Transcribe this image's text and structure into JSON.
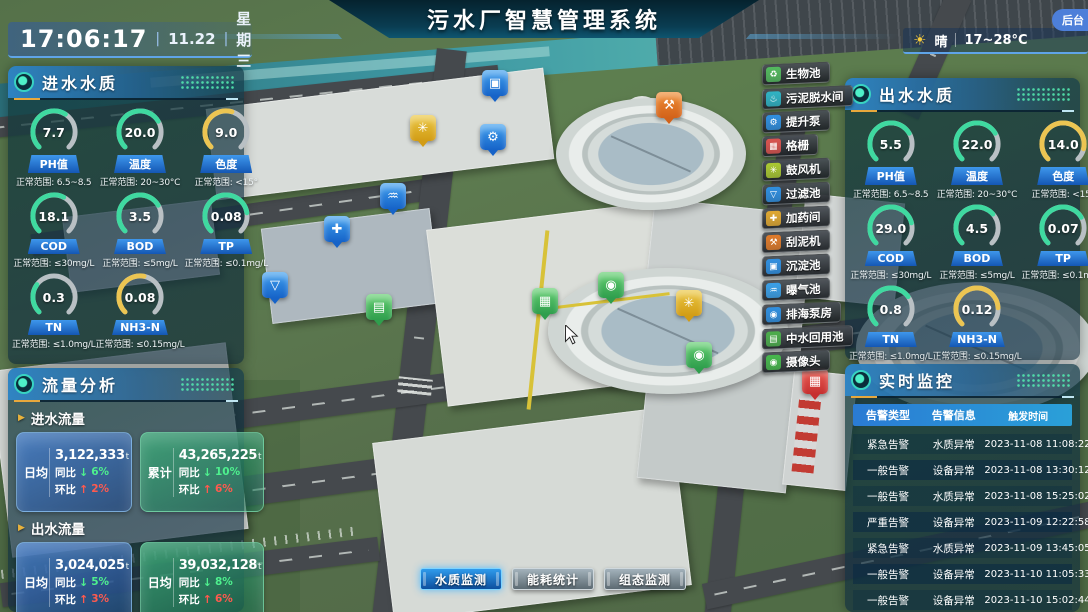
{
  "header": {
    "title": "污水厂智慧管理系统",
    "time": "17:06:17",
    "date": "11.22",
    "weekday": "星期三",
    "weather": {
      "icon": "sun-icon",
      "condition": "晴",
      "temp_range": "17~28°C"
    },
    "backend_label": "后台"
  },
  "colors": {
    "green": "#3fd9a0",
    "yellow": "#ecc552",
    "blue_accent": "#2f8de8",
    "track": "#b9c0c4"
  },
  "inlet_quality": {
    "title": "进水水质",
    "gauges": [
      {
        "label": "PH值",
        "value": "7.7",
        "range": "正常范围: 6.5~8.5",
        "color": "green",
        "percent": 62
      },
      {
        "label": "温度",
        "value": "20.0",
        "range": "正常范围: 20~30°C",
        "color": "green",
        "percent": 72
      },
      {
        "label": "色度",
        "value": "9.0",
        "range": "正常范围: <15°",
        "color": "yellow",
        "percent": 56
      },
      {
        "label": "COD",
        "value": "18.1",
        "range": "正常范围: ≤30mg/L",
        "color": "green",
        "percent": 60
      },
      {
        "label": "BOD",
        "value": "3.5",
        "range": "正常范围: ≤5mg/L",
        "color": "green",
        "percent": 72
      },
      {
        "label": "TP",
        "value": "0.08",
        "range": "正常范围: ≤0.1mg/L",
        "color": "green",
        "percent": 80
      },
      {
        "label": "TN",
        "value": "0.3",
        "range": "正常范围: ≤1.0mg/L",
        "color": "green",
        "percent": 30
      },
      {
        "label": "NH3-N",
        "value": "0.08",
        "range": "正常范围: ≤0.15mg/L",
        "color": "yellow",
        "percent": 54
      }
    ]
  },
  "outlet_quality": {
    "title": "出水水质",
    "gauges": [
      {
        "label": "PH值",
        "value": "5.5",
        "range": "正常范围: 6.5~8.5",
        "color": "green",
        "percent": 72
      },
      {
        "label": "温度",
        "value": "22.0",
        "range": "正常范围: 20~30°C",
        "color": "green",
        "percent": 72
      },
      {
        "label": "色度",
        "value": "14.0",
        "range": "正常范围: <15°",
        "color": "yellow",
        "percent": 88
      },
      {
        "label": "COD",
        "value": "29.0",
        "range": "正常范围: ≤30mg/L",
        "color": "green",
        "percent": 78
      },
      {
        "label": "BOD",
        "value": "4.5",
        "range": "正常范围: ≤5mg/L",
        "color": "green",
        "percent": 68
      },
      {
        "label": "TP",
        "value": "0.07",
        "range": "正常范围: ≤0.1mg/L",
        "color": "green",
        "percent": 72
      },
      {
        "label": "TN",
        "value": "0.8",
        "range": "正常范围: ≤1.0mg/L",
        "color": "green",
        "percent": 70
      },
      {
        "label": "NH3-N",
        "value": "0.12",
        "range": "正常范围: ≤0.15mg/L",
        "color": "yellow",
        "percent": 82
      }
    ]
  },
  "flow_analysis": {
    "title": "流量分析",
    "groups": [
      {
        "subtitle": "进水流量",
        "cards": [
          {
            "label": "日均",
            "value": "3,122,333",
            "unit": "t",
            "style": "blue",
            "yoy": {
              "label": "同比",
              "value": "6%",
              "trend": "down"
            },
            "mom": {
              "label": "环比",
              "value": "2%",
              "trend": "up"
            }
          },
          {
            "label": "累计",
            "value": "43,265,225",
            "unit": "t",
            "style": "green",
            "yoy": {
              "label": "同比",
              "value": "10%",
              "trend": "down"
            },
            "mom": {
              "label": "环比",
              "value": "6%",
              "trend": "up"
            }
          }
        ]
      },
      {
        "subtitle": "出水流量",
        "cards": [
          {
            "label": "日均",
            "value": "3,024,025",
            "unit": "t",
            "style": "blue",
            "yoy": {
              "label": "同比",
              "value": "5%",
              "trend": "down"
            },
            "mom": {
              "label": "环比",
              "value": "3%",
              "trend": "up"
            }
          },
          {
            "label": "日均",
            "value": "39,032,128",
            "unit": "t",
            "style": "green",
            "yoy": {
              "label": "同比",
              "value": "8%",
              "trend": "down"
            },
            "mom": {
              "label": "环比",
              "value": "6%",
              "trend": "up"
            }
          }
        ]
      }
    ]
  },
  "monitoring": {
    "title": "实时监控",
    "columns": [
      "告警类型",
      "告警信息",
      "触发时间"
    ],
    "rows": [
      [
        "紧急告警",
        "水质异常",
        "2023-11-08 11:08:22"
      ],
      [
        "一般告警",
        "设备异常",
        "2023-11-08 13:30:12"
      ],
      [
        "一般告警",
        "水质异常",
        "2023-11-08 15:25:02"
      ],
      [
        "严重告警",
        "设备异常",
        "2023-11-09 12:22:58"
      ],
      [
        "紧急告警",
        "水质异常",
        "2023-11-09 13:45:05"
      ],
      [
        "一般告警",
        "设备异常",
        "2023-11-10 11:05:33"
      ],
      [
        "一般告警",
        "设备异常",
        "2023-11-10 15:02:44"
      ]
    ]
  },
  "legend": {
    "items": [
      {
        "label": "生物池",
        "icon": "bio-pool-icon",
        "glyph": "bio",
        "color": "#53b95e"
      },
      {
        "label": "污泥脱水间",
        "icon": "sludge-dewatering-icon",
        "glyph": "dewater",
        "color": "#2fb3c4"
      },
      {
        "label": "提升泵",
        "icon": "lift-pump-icon",
        "glyph": "pump",
        "color": "#2f8fe0"
      },
      {
        "label": "格栅",
        "icon": "grille-icon",
        "glyph": "grille",
        "color": "#d9534f"
      },
      {
        "label": "鼓风机",
        "icon": "blower-icon",
        "glyph": "fan",
        "color": "#aac832"
      },
      {
        "label": "过滤池",
        "icon": "filter-pool-icon",
        "glyph": "funnel",
        "color": "#2f8fe0"
      },
      {
        "label": "加药间",
        "icon": "dosing-room-icon",
        "glyph": "dosing",
        "color": "#e0a831"
      },
      {
        "label": "刮泥机",
        "icon": "mud-scraper-icon",
        "glyph": "scraper",
        "color": "#e07b2a"
      },
      {
        "label": "沉淀池",
        "icon": "sedimentation-icon",
        "glyph": "tank",
        "color": "#2f8fe0"
      },
      {
        "label": "曝气池",
        "icon": "aeration-pool-icon",
        "glyph": "aeration",
        "color": "#3aa0e8"
      },
      {
        "label": "排海泵房",
        "icon": "sea-pump-house-icon",
        "glyph": "pumphouse",
        "color": "#2f8fe0"
      },
      {
        "label": "中水回用池",
        "icon": "water-reuse-pool-icon",
        "glyph": "reuse",
        "color": "#4cae4c"
      },
      {
        "label": "摄像头",
        "icon": "camera-icon",
        "glyph": "camera",
        "color": "#46b84c"
      }
    ]
  },
  "map": {
    "markers": [
      {
        "name": "sedimentation-marker",
        "glyph": "tank",
        "color": "blue",
        "x": 482,
        "y": 70
      },
      {
        "name": "blower-marker",
        "glyph": "fan",
        "color": "yellow",
        "x": 410,
        "y": 115
      },
      {
        "name": "lift-pump-marker",
        "glyph": "pump",
        "color": "blue",
        "x": 480,
        "y": 124
      },
      {
        "name": "scraper-marker",
        "glyph": "scraper",
        "color": "orange",
        "x": 656,
        "y": 92
      },
      {
        "name": "aeration-marker",
        "glyph": "aeration",
        "color": "blue",
        "x": 380,
        "y": 183
      },
      {
        "name": "dosing-marker",
        "glyph": "dosing",
        "color": "blue",
        "x": 324,
        "y": 216
      },
      {
        "name": "filter-marker",
        "glyph": "funnel",
        "color": "blue",
        "x": 262,
        "y": 272
      },
      {
        "name": "reuse-pool-marker",
        "glyph": "reuse",
        "color": "green",
        "x": 366,
        "y": 294
      },
      {
        "name": "aeration-pool-marker",
        "glyph": "grille",
        "color": "green",
        "x": 532,
        "y": 288
      },
      {
        "name": "camera-marker-1",
        "glyph": "camera",
        "color": "green",
        "x": 598,
        "y": 272
      },
      {
        "name": "blower-marker-2",
        "glyph": "fan",
        "color": "yellow",
        "x": 676,
        "y": 290
      },
      {
        "name": "camera-marker-2",
        "glyph": "camera",
        "color": "green",
        "x": 686,
        "y": 342
      },
      {
        "name": "grille-marker",
        "glyph": "grille",
        "color": "red",
        "x": 802,
        "y": 368
      }
    ]
  },
  "bottom_buttons": [
    {
      "label": "水质监测",
      "active": true
    },
    {
      "label": "能耗统计",
      "active": false
    },
    {
      "label": "组态监测",
      "active": false
    }
  ]
}
